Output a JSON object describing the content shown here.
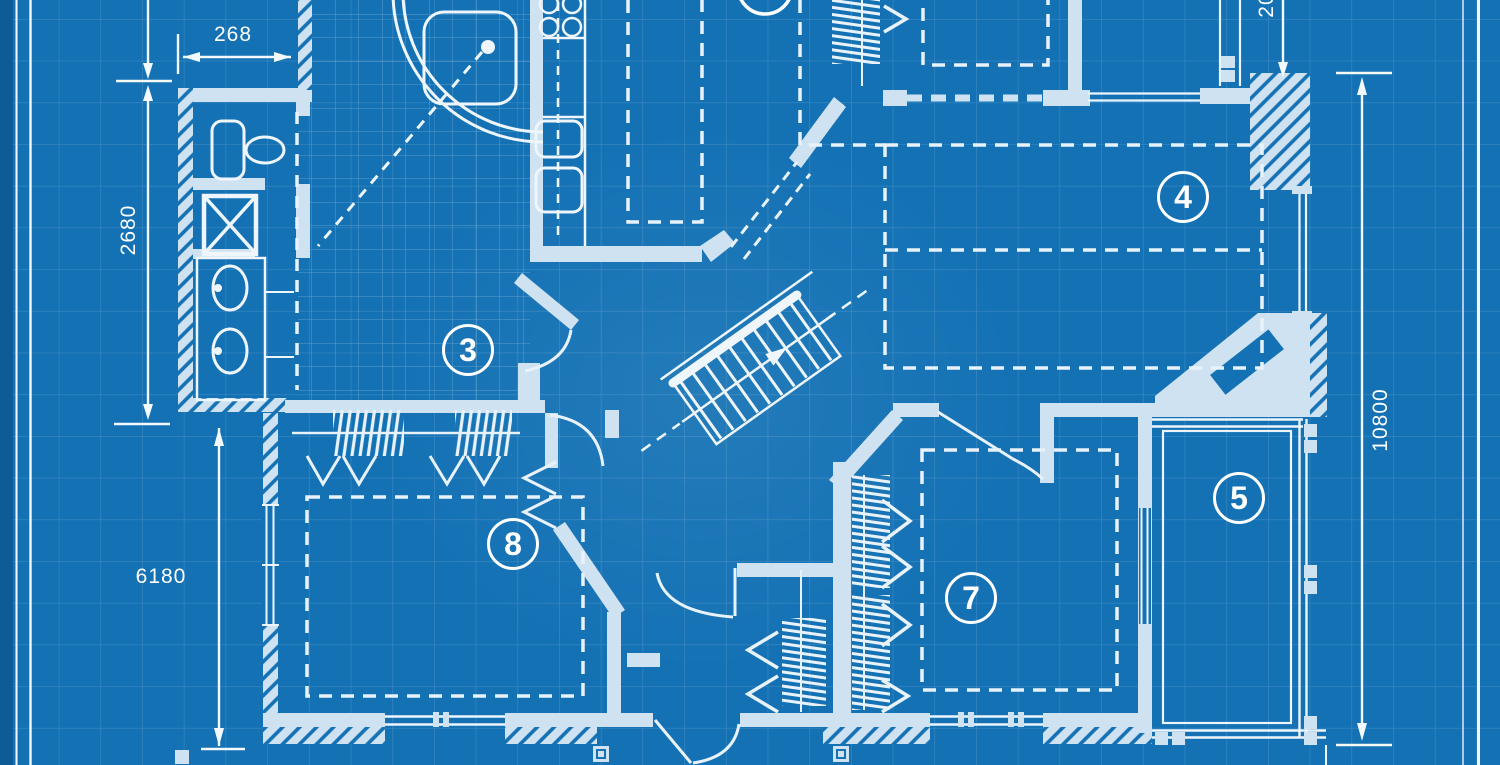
{
  "title": "House floor plan blueprint",
  "colors": {
    "background": "#1371b4",
    "edge_margin": "#0d5c98",
    "wall": "#cfe2f1",
    "line": "#eef6fc",
    "text": "#ffffff"
  },
  "rooms": {
    "r3": "3",
    "r4": "4",
    "r5": "5",
    "r7": "7",
    "r8": "8"
  },
  "dimensions": {
    "top_left_width": "268",
    "left_upper_height": "2680",
    "left_lower_height": "6180",
    "right_height": "10800",
    "top_right_partial": "20"
  }
}
